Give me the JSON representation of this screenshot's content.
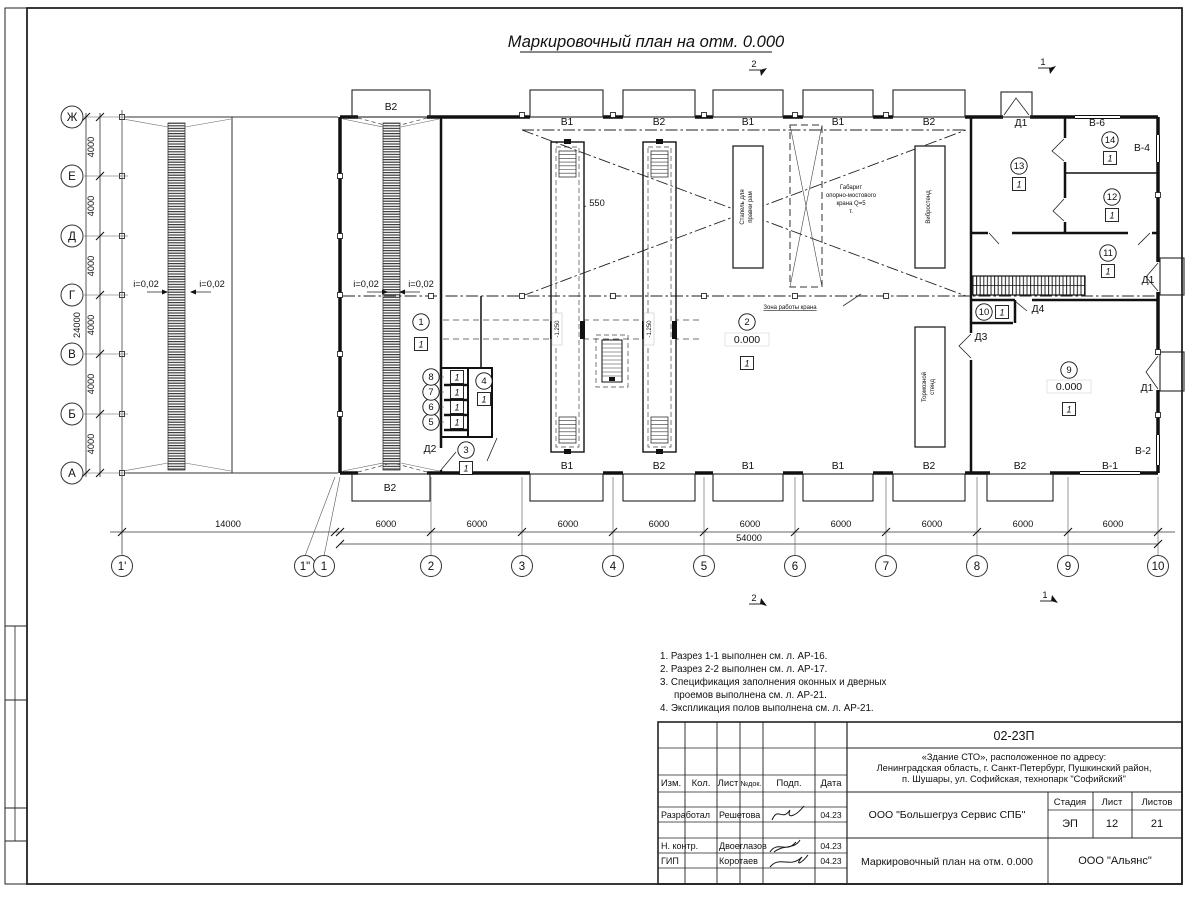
{
  "sheet_title": "Маркировочный план на отм. 0.000",
  "notes": [
    "1. Разрез 1-1 выполнен см. л. АР-16.",
    "2. Разрез 2-2 выполнен см. л. АР-17.",
    "3. Спецификация заполнения оконных и дверных",
    "проемов выполнена см. л. АР-21.",
    "4. Экспликация полов выполнена см. л. АР-21."
  ],
  "grid": {
    "row_axes": [
      {
        "label": "Ж",
        "y": 117
      },
      {
        "label": "Е",
        "y": 176
      },
      {
        "label": "Д",
        "y": 236
      },
      {
        "label": "Г",
        "y": 295
      },
      {
        "label": "В",
        "y": 354
      },
      {
        "label": "Б",
        "y": 414
      },
      {
        "label": "А",
        "y": 473
      }
    ],
    "col_axes": [
      {
        "label": "1'",
        "x": 122,
        "cx": 122
      },
      {
        "label": "1\"",
        "x": 335,
        "cx": 305
      },
      {
        "label": "1",
        "x": 340,
        "cx": 324
      },
      {
        "label": "2",
        "x": 431,
        "cx": 431
      },
      {
        "label": "3",
        "x": 522,
        "cx": 522
      },
      {
        "label": "4",
        "x": 613,
        "cx": 613
      },
      {
        "label": "5",
        "x": 704,
        "cx": 704
      },
      {
        "label": "6",
        "x": 795,
        "cx": 795
      },
      {
        "label": "7",
        "x": 886,
        "cx": 886
      },
      {
        "label": "8",
        "x": 977,
        "cx": 977
      },
      {
        "label": "9",
        "x": 1068,
        "cx": 1068
      },
      {
        "label": "10",
        "x": 1158,
        "cx": 1158
      }
    ]
  },
  "dimensions": [
    {
      "text": "4000",
      "x": 94,
      "y": 147,
      "rot": true
    },
    {
      "text": "4000",
      "x": 94,
      "y": 206,
      "rot": true
    },
    {
      "text": "4000",
      "x": 94,
      "y": 266,
      "rot": true
    },
    {
      "text": "4000",
      "x": 94,
      "y": 325,
      "rot": true
    },
    {
      "text": "4000",
      "x": 94,
      "y": 384,
      "rot": true
    },
    {
      "text": "4000",
      "x": 94,
      "y": 444,
      "rot": true
    },
    {
      "text": "24000",
      "x": 80,
      "y": 325,
      "rot": true
    },
    {
      "text": "14000",
      "x": 228,
      "y": 527
    },
    {
      "text": "6000",
      "x": 386,
      "y": 527
    },
    {
      "text": "6000",
      "x": 477,
      "y": 527
    },
    {
      "text": "6000",
      "x": 568,
      "y": 527
    },
    {
      "text": "6000",
      "x": 659,
      "y": 527
    },
    {
      "text": "6000",
      "x": 750,
      "y": 527
    },
    {
      "text": "6000",
      "x": 841,
      "y": 527
    },
    {
      "text": "6000",
      "x": 932,
      "y": 527
    },
    {
      "text": "6000",
      "x": 1023,
      "y": 527
    },
    {
      "text": "6000",
      "x": 1113,
      "y": 527
    },
    {
      "text": "54000",
      "x": 749,
      "y": 541
    },
    {
      "text": "550",
      "x": 597,
      "y": 206
    }
  ],
  "slopes": [
    {
      "text": "i=0,02",
      "x": 146,
      "y": 287,
      "dir": "right"
    },
    {
      "text": "i=0,02",
      "x": 212,
      "y": 287,
      "dir": "left"
    },
    {
      "text": "i=0,02",
      "x": 366,
      "y": 287,
      "dir": "right"
    },
    {
      "text": "i=0,02",
      "x": 421,
      "y": 287,
      "dir": "left"
    }
  ],
  "rooms": [
    {
      "num": "1",
      "x": 421,
      "y": 322,
      "floor": "1",
      "fx": 421,
      "fy": 344
    },
    {
      "num": "2",
      "x": 747,
      "y": 322,
      "elev": "0.000",
      "ey": 343,
      "floor": "1",
      "fx": 747,
      "fy": 363
    },
    {
      "num": "3",
      "x": 466,
      "y": 450,
      "floor": "1",
      "fx": 466,
      "fy": 468
    },
    {
      "num": "4",
      "x": 484,
      "y": 381,
      "floor": "1",
      "fx": 484,
      "fy": 399
    },
    {
      "num": "5",
      "x": 431,
      "y": 422,
      "floor": "1",
      "fx": 457,
      "fy": 422
    },
    {
      "num": "6",
      "x": 431,
      "y": 407,
      "floor": "1",
      "fx": 457,
      "fy": 407
    },
    {
      "num": "7",
      "x": 431,
      "y": 392,
      "floor": "1",
      "fx": 457,
      "fy": 392
    },
    {
      "num": "8",
      "x": 431,
      "y": 377,
      "floor": "1",
      "fx": 457,
      "fy": 377
    },
    {
      "num": "9",
      "x": 1069,
      "y": 370,
      "elev": "0.000",
      "ey": 390,
      "floor": "1",
      "fx": 1069,
      "fy": 409
    },
    {
      "num": "10",
      "x": 984,
      "y": 312,
      "floor": "1",
      "fx": 1002,
      "fy": 312
    },
    {
      "num": "11",
      "x": 1108,
      "y": 253,
      "floor": "1",
      "fx": 1108,
      "fy": 271
    },
    {
      "num": "12",
      "x": 1112,
      "y": 197,
      "floor": "1",
      "fx": 1112,
      "fy": 215
    },
    {
      "num": "13",
      "x": 1019,
      "y": 166,
      "floor": "1",
      "fx": 1019,
      "fy": 184
    },
    {
      "num": "14",
      "x": 1110,
      "y": 140,
      "floor": "1",
      "fx": 1110,
      "fy": 158
    }
  ],
  "openings": [
    {
      "text": "В2",
      "x": 391,
      "y": 110
    },
    {
      "text": "В1",
      "x": 567,
      "y": 125
    },
    {
      "text": "В2",
      "x": 659,
      "y": 125
    },
    {
      "text": "В1",
      "x": 748,
      "y": 125
    },
    {
      "text": "В1",
      "x": 838,
      "y": 125
    },
    {
      "text": "В2",
      "x": 929,
      "y": 125
    },
    {
      "text": "Д1",
      "x": 1021,
      "y": 126
    },
    {
      "text": "В-6",
      "x": 1097,
      "y": 126
    },
    {
      "text": "В-4",
      "x": 1142,
      "y": 151
    },
    {
      "text": "Д1",
      "x": 1148,
      "y": 283
    },
    {
      "text": "Д1",
      "x": 1147,
      "y": 391
    },
    {
      "text": "В-2",
      "x": 1143,
      "y": 454
    },
    {
      "text": "В1",
      "x": 567,
      "y": 469
    },
    {
      "text": "В2",
      "x": 659,
      "y": 469
    },
    {
      "text": "В1",
      "x": 748,
      "y": 469
    },
    {
      "text": "В1",
      "x": 838,
      "y": 469
    },
    {
      "text": "В2",
      "x": 929,
      "y": 469
    },
    {
      "text": "В2",
      "x": 1020,
      "y": 469
    },
    {
      "text": "В-1",
      "x": 1110,
      "y": 469
    },
    {
      "text": "В2",
      "x": 390,
      "y": 491
    },
    {
      "text": "Д2",
      "x": 430,
      "y": 452
    },
    {
      "text": "Д3",
      "x": 981,
      "y": 340
    },
    {
      "text": "Д4",
      "x": 1038,
      "y": 312
    }
  ],
  "annotations": {
    "pit_depth": "-1.250",
    "crane_lines": [
      "Габарит",
      "опорно-мостового",
      "крана Q=5",
      "т."
    ],
    "crane_zone": "Зона работы крана",
    "equipment": [
      {
        "lines": [
          "Стапель для",
          "правки рам"
        ],
        "x": 748,
        "y": 207
      },
      {
        "lines": [
          "Вибростенд"
        ],
        "x": 930,
        "y": 207
      },
      {
        "lines": [
          "Тормозной",
          "стенд"
        ],
        "x": 930,
        "y": 387
      }
    ]
  },
  "sections": [
    {
      "num": "2",
      "x": 754,
      "y": 67
    },
    {
      "num": "1",
      "x": 1043,
      "y": 65
    },
    {
      "num": "2",
      "x": 754,
      "y": 601
    },
    {
      "num": "1",
      "x": 1045,
      "y": 598
    }
  ],
  "title_block": {
    "doc_number": "02-23П",
    "project_lines": [
      "«Здание СТО», расположенное по адресу:",
      "Ленинградская область, г. Санкт-Петербург, Пушкинский район,",
      "п. Шушары, ул. Софийская, технопарк \"Софийский\""
    ],
    "columns": [
      "Изм.",
      "Кол.",
      "Лист",
      "№док.",
      "Подп.",
      "Дата"
    ],
    "rows": [
      {
        "role": "Разработал",
        "name": "Решетова",
        "date": "04.23"
      },
      {
        "role": "Н. контр.",
        "name": "Двоеглазов",
        "date": "04.23"
      },
      {
        "role": "ГИП",
        "name": "Коротаев",
        "date": "04.23"
      }
    ],
    "company": "ООО \"Большегруз Сервис СПБ\"",
    "stage_cols": [
      "Стадия",
      "Лист",
      "Листов"
    ],
    "stage": "ЭП",
    "sheet_num": "12",
    "sheets_total": "21",
    "sheet_name": "Маркировочный план на отм. 0.000",
    "org": "ООО \"Альянс\""
  }
}
